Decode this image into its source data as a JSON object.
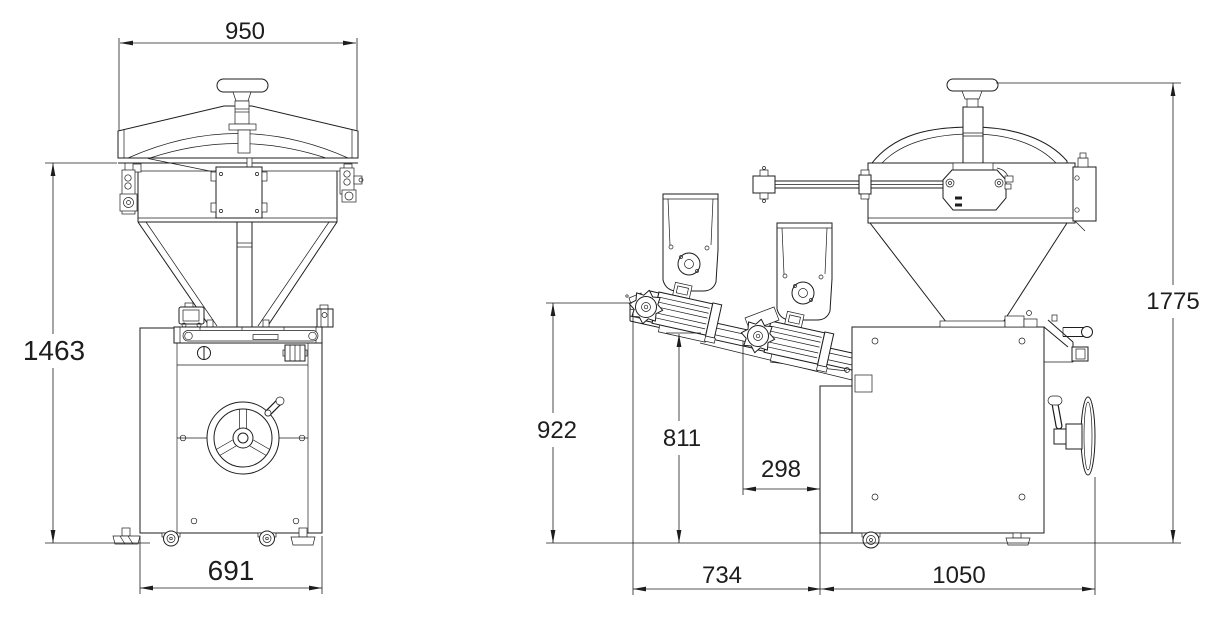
{
  "page": {
    "background": "#ffffff",
    "ink": "#1d1d1d",
    "drawing_type": "technical dimension drawing, dough divider machine, front and side orthographic views"
  },
  "views": {
    "front": {
      "label": "front-view",
      "dims": {
        "top_width": "950",
        "overall_height": "1463",
        "base_width": "691"
      }
    },
    "side": {
      "label": "side-view",
      "dims": {
        "overall_height": "1775",
        "feeder_inlet_height": "922",
        "feeder_low_height": "811",
        "outlet_offset": "298",
        "feeder_overhang": "734",
        "body_depth": "1050"
      }
    }
  }
}
